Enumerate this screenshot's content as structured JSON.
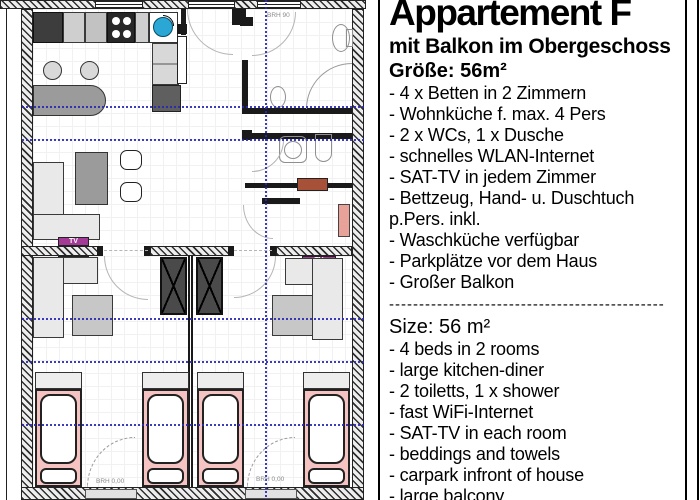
{
  "info": {
    "title": "Appartement F",
    "subtitle": "mit Balkon im Obergeschoss",
    "size_de": "Größe: 56m²",
    "features_de": [
      "- 4 x Betten in 2 Zimmern",
      "- Wohnküche f. max. 4 Pers",
      "- 2 x WCs,  1 x Dusche",
      "- schnelles WLAN-Internet",
      "- SAT-TV in jedem Zimmer",
      "- Bettzeug, Hand- u. Duschtuch p.Pers. inkl.",
      "- Waschküche verfügbar",
      "- Parkplätze vor dem Haus",
      "- Großer Balkon"
    ],
    "separator": "----------------------------------------------",
    "size_en": "Size: 56 m²",
    "features_en": [
      "- 4 beds in 2 rooms",
      "- large kitchen-diner",
      "- 2 toiletts, 1 x shower",
      "- fast WiFi-Internet",
      "- SAT-TV in each room",
      "- beddings and towels",
      "- carpark infront of house",
      "- large balcony"
    ]
  },
  "plan": {
    "labels": {
      "window_sill_height": "BRH 90",
      "door_sill": "BRH 0,00",
      "tv": "TV"
    },
    "colors": {
      "bed_pink": "#f6c3c3",
      "tv_magenta": "#a33b96",
      "sink_blue": "#2aa7d4",
      "bench_brown": "#a65138",
      "bench_salmon": "#e9a29a",
      "roof_guide_blue": "#2727b5"
    }
  }
}
